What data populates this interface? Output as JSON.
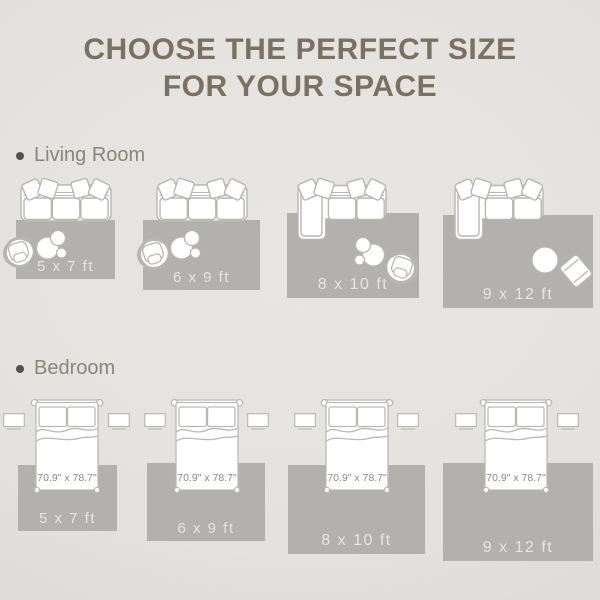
{
  "title": {
    "line1": "CHOOSE THE PERFECT SIZE",
    "line2": "FOR YOUR SPACE"
  },
  "living_room": {
    "label": "Living Room",
    "rugs": [
      {
        "size": "5 x 7 ft"
      },
      {
        "size": "6 x 9 ft"
      },
      {
        "size": "8 x 10 ft"
      },
      {
        "size": "9 x 12 ft"
      }
    ]
  },
  "bedroom": {
    "label": "Bedroom",
    "bed_size": "70.9\" x 78.7\"",
    "rugs": [
      {
        "size": "5 x 7 ft"
      },
      {
        "size": "6 x 9 ft"
      },
      {
        "size": "8 x 10 ft"
      },
      {
        "size": "9 x 12 ft"
      }
    ]
  },
  "colors": {
    "background": "#e4e2df",
    "rug": "#b3b1ae",
    "furniture_outline": "#b9b6b1",
    "furniture_fill": "#ffffff",
    "title_text": "#7b7163",
    "section_text": "#8b857a",
    "rug_label_text": "#e7e5e1",
    "bed_label_text": "#8c8984"
  }
}
